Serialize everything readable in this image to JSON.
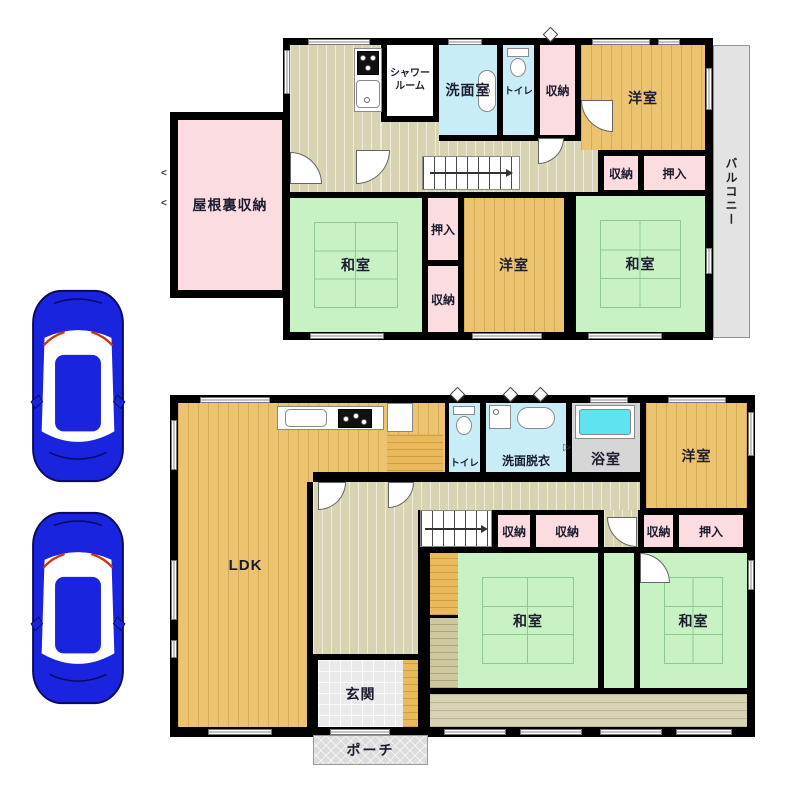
{
  "palette": {
    "wood_floor": "#ecc46f",
    "tatami_green": "#c9f2c4",
    "hall_beige": "#d8d3b2",
    "storage_pink": "#fbdce0",
    "wet_area_blue": "#c9edf7",
    "bath_gray": "#d6d6d6",
    "tub_cyan": "#5ee4f0",
    "balcony_gray": "#e3e3e3",
    "wall_black": "#000000",
    "car_blue": "#1a23dd"
  },
  "cars": {
    "count": 2,
    "color": "#1a23dd"
  },
  "floor2": {
    "attic_storage": "屋根裏収納",
    "shower_room": "シャワールーム",
    "washroom": "洗面室",
    "toilet": "トイレ",
    "closet_top": "収納",
    "western_room_top": "洋室",
    "closet_right": "収納",
    "oshiire_right": "押入",
    "japanese_room_left": "和室",
    "oshiire_mid": "押入",
    "closet_mid": "収納",
    "western_room_mid": "洋室",
    "japanese_room_right": "和室",
    "balcony": "バルコニー"
  },
  "floor1": {
    "ldk": "LDK",
    "toilet": "トイレ",
    "washroom_dressing": "洗面脱衣",
    "bathroom": "浴室",
    "western_room": "洋室",
    "closet_a": "収納",
    "closet_b": "収納",
    "closet_c": "収納",
    "oshiire": "押入",
    "japanese_room_left": "和室",
    "japanese_room_right": "和室",
    "entrance": "玄関",
    "porch": "ポーチ"
  }
}
